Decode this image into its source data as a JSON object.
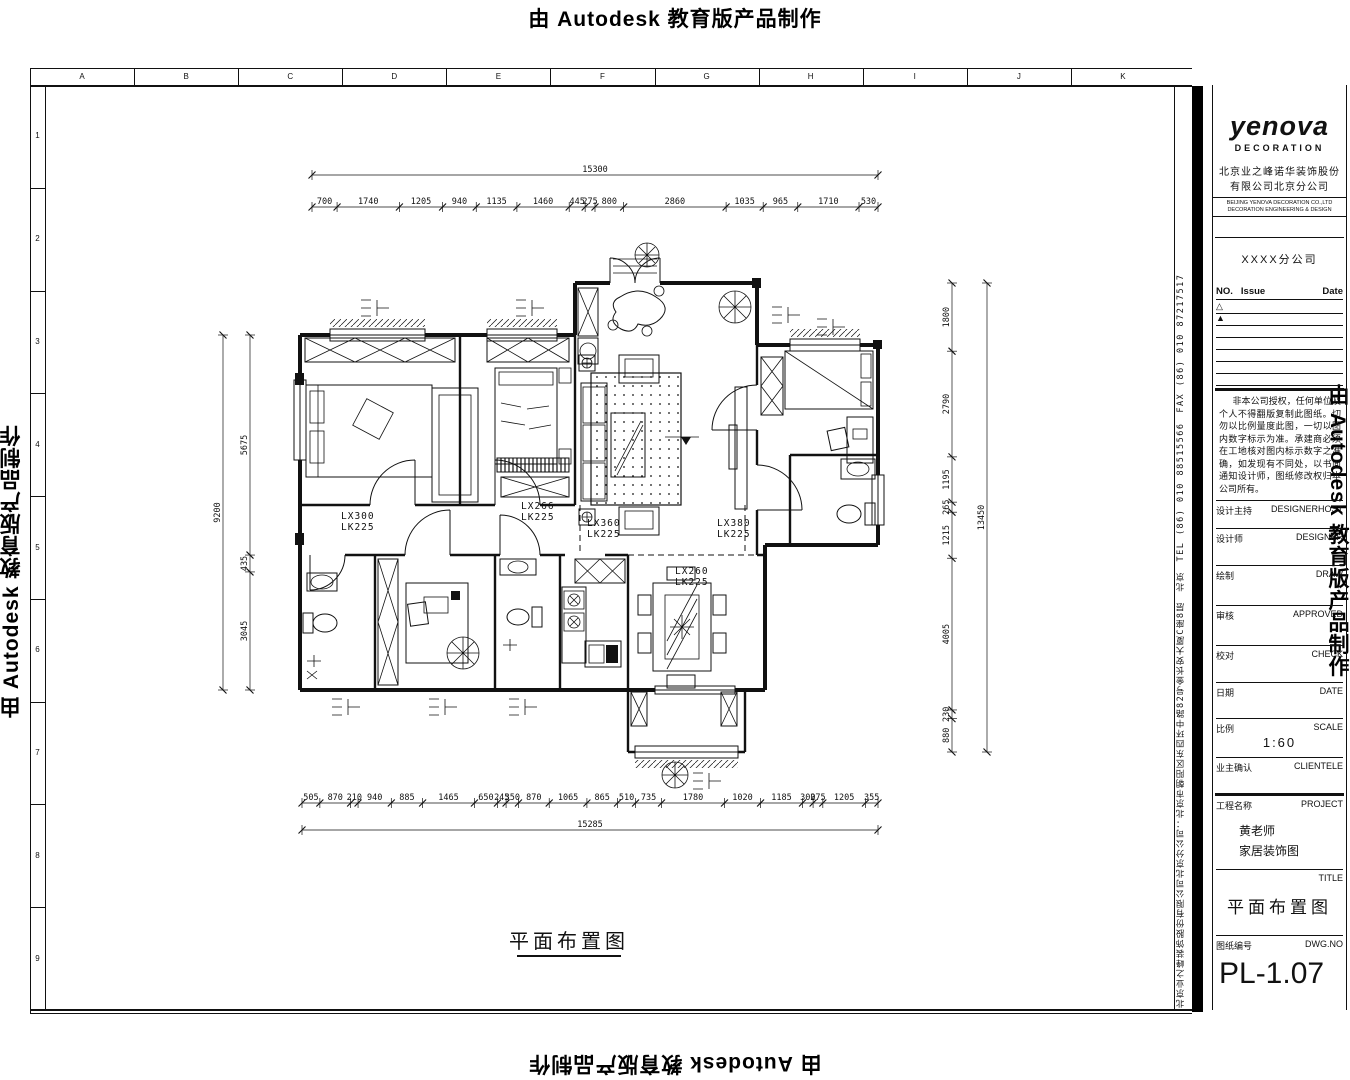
{
  "watermark": {
    "stamp": "由 Autodesk 教育版产品制作"
  },
  "frame": {
    "top_letters": [
      "A",
      "B",
      "C",
      "D",
      "E",
      "F",
      "G",
      "H",
      "I",
      "J",
      "K"
    ],
    "left_numbers": [
      "1",
      "2",
      "3",
      "4",
      "5",
      "6",
      "7",
      "8",
      "9"
    ]
  },
  "strip": {
    "address": "北京业之峰装饰股份有限公司北京分公司：北京市朝阳区东四环中路82号金长安大厦C座8层　北京　TEL (86) 010 88515566　FAX (86) 010 87217517"
  },
  "title_block": {
    "logo": {
      "name": "yenova",
      "sub": "DECORATION",
      "cn1": "北京业之峰诺华装饰股份",
      "cn2": "有限公司北京分公司",
      "en1": "BEIJING YENOVA DECORATION CO.,LTD",
      "en2": "DECORATION ENGINEERING & DESIGN"
    },
    "branch": "XXXX分公司",
    "rev": {
      "no": "NO.",
      "issue": "Issue",
      "date": "Date",
      "marks": [
        "△",
        "▲"
      ]
    },
    "notes": "非本公司授权，任何单位及个人不得翻版复制此图纸。切勿以比例量度此图，一切以图内数字标示为准。承建商必须在工地核对图内标示数字之准确，如发现有不同处，以书面通知设计师，图纸修改权归本公司所有。",
    "fields": [
      {
        "cn": "设计主持",
        "en": "DESIGNERHOST"
      },
      {
        "cn": "设计师",
        "en": "DESIGNER"
      },
      {
        "cn": "绘制",
        "en": "DRAW"
      },
      {
        "cn": "审核",
        "en": "APPROVED"
      },
      {
        "cn": "校对",
        "en": "CHECK"
      },
      {
        "cn": "日期",
        "en": "DATE"
      }
    ],
    "scale": {
      "cn": "比例",
      "en": "SCALE",
      "value": "1:60"
    },
    "client": {
      "cn": "业主确认",
      "en": "CLIENTELE"
    },
    "project": {
      "cn": "工程名称",
      "en": "PROJECT",
      "line1": "黄老师",
      "line2": "家居装饰图"
    },
    "sheet": {
      "en": "TITLE",
      "value": "平面布置图"
    },
    "dwg": {
      "cn": "图纸编号",
      "en": "DWG.NO",
      "value": "PL-1.07"
    }
  },
  "plan": {
    "caption": "平面布置图",
    "beams": [
      {
        "t": "LX300",
        "k": "LK225",
        "x": 306,
        "y": 434
      },
      {
        "t": "LX266",
        "k": "LK225",
        "x": 486,
        "y": 424
      },
      {
        "t": "LX360",
        "k": "LK225",
        "x": 552,
        "y": 441
      },
      {
        "t": "LX380",
        "k": "LK225",
        "x": 682,
        "y": 441
      },
      {
        "t": "LX260",
        "k": "LK225",
        "x": 640,
        "y": 489
      }
    ],
    "dims": {
      "top_total": {
        "o": "h",
        "x0": 277,
        "x1": 843,
        "c": 90,
        "values": [
          15300
        ]
      },
      "top_segments": {
        "o": "h",
        "x0": 277,
        "x1": 843,
        "c": 122,
        "values": [
          700,
          1740,
          1205,
          940,
          1135,
          1460,
          445,
          275,
          800,
          2860,
          1035,
          965,
          1710,
          530
        ]
      },
      "bottom_segments": {
        "o": "h",
        "x0": 267,
        "x1": 843,
        "c": 718,
        "values": [
          505,
          870,
          210,
          940,
          885,
          1465,
          650,
          245,
          350,
          870,
          1065,
          865,
          510,
          735,
          1780,
          1020,
          1185,
          300,
          275,
          1205,
          355
        ]
      },
      "bottom_total": {
        "o": "h",
        "x0": 267,
        "x1": 843,
        "c": 745,
        "values": [
          15285
        ]
      },
      "left_total": {
        "o": "v",
        "y0": 250,
        "y1": 605,
        "c": 188,
        "values": [
          9200
        ]
      },
      "left_segments": {
        "o": "v",
        "y0": 250,
        "y1": 605,
        "c": 215,
        "values": [
          5675,
          435,
          3045
        ]
      },
      "right_segments": {
        "o": "v",
        "y0": 198,
        "y1": 667,
        "c": 917,
        "values": [
          1800,
          2790,
          1195,
          265,
          1215,
          4005,
          230,
          880
        ]
      },
      "right_total": {
        "o": "v",
        "y0": 198,
        "y1": 667,
        "c": 952,
        "values": [
          13450
        ]
      }
    }
  }
}
